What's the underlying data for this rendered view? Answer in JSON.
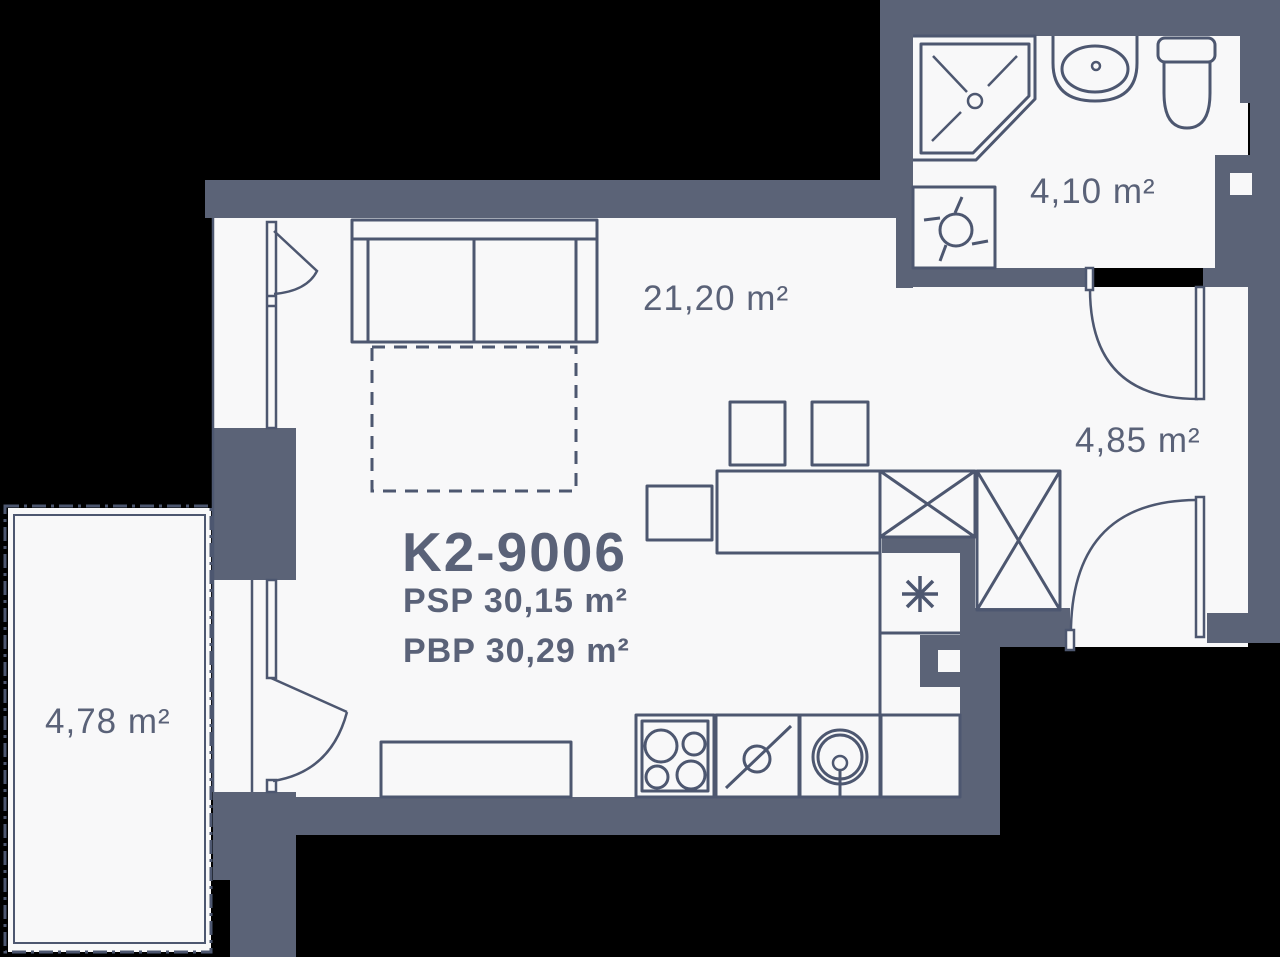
{
  "plan": {
    "unit_id": "K2-9006",
    "psp_label": "PSP 30,15 m²",
    "pbp_label": "PBP 30,29 m²",
    "rooms": {
      "living": {
        "area": "21,20 m²"
      },
      "bathroom": {
        "area": "4,10 m²"
      },
      "hallway": {
        "area": "4,85 m²"
      },
      "balcony": {
        "area": "4,78 m²"
      }
    },
    "colors": {
      "wall": "#5b6377",
      "line": "#4d5770",
      "floor": "#f8f8f9",
      "background": "#000000",
      "text": "#5a6278"
    }
  }
}
